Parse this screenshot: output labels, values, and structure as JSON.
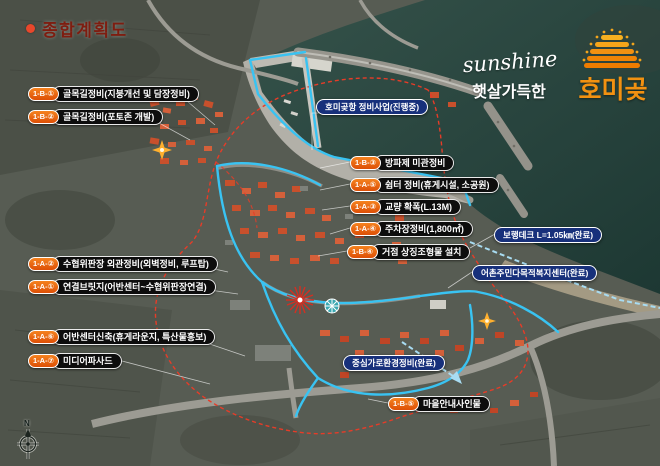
{
  "title": {
    "text": "종합계획도"
  },
  "logo": {
    "script": "sunshine",
    "tagline": "햇살가득한",
    "place": "호미곶"
  },
  "compass": {
    "north_label": "N"
  },
  "project_labels": [
    {
      "code": "1-B-①",
      "text": "골목길정비(지붕개선 및 담장정비)"
    },
    {
      "code": "1-B-②",
      "text": "골목길정비(포토존 개발)"
    },
    {
      "code": "1-A-②",
      "text": "수협위판장 외관정비(외벽정비, 루프탑)"
    },
    {
      "code": "1-A-①",
      "text": "연결브릿지(어반센터~수협위판장연결)"
    },
    {
      "code": "1-A-⑥",
      "text": "어반센터신축(휴게라운지, 특산물홍보)"
    },
    {
      "code": "1-A-⑦",
      "text": "미디어파사드"
    },
    {
      "code": "1-B-③",
      "text": "방파제 미관정비"
    },
    {
      "code": "1-A-⑤",
      "text": "쉼터 정비(휴게시설, 소공원)"
    },
    {
      "code": "1-A-③",
      "text": "교량 확폭(L.13M)"
    },
    {
      "code": "1-A-④",
      "text": "주차장정비(1,800㎡)"
    },
    {
      "code": "1-B-④",
      "text": "거점 상징조형물 설치"
    },
    {
      "code": "1-B-⑤",
      "text": "마을안내사인물"
    }
  ],
  "status_labels": [
    {
      "text": "호미곶항 정비사업(진행중)"
    },
    {
      "text": "보행데크 L=1.05㎞(완료)"
    },
    {
      "text": "어촌주민다목적복지센터(완료)"
    },
    {
      "text": "중심가로환경정비(완료)"
    }
  ],
  "colors": {
    "title_red": "#7e1d10",
    "badge_orange": "#e8590c",
    "pill_black": "#0d0d0d",
    "status_navy": "#17307b",
    "highlight_cyan": "#39c3f2",
    "boundary_red": "#e63c28",
    "logo_orange": "#f29111",
    "roof_orange": "#c8502c"
  }
}
